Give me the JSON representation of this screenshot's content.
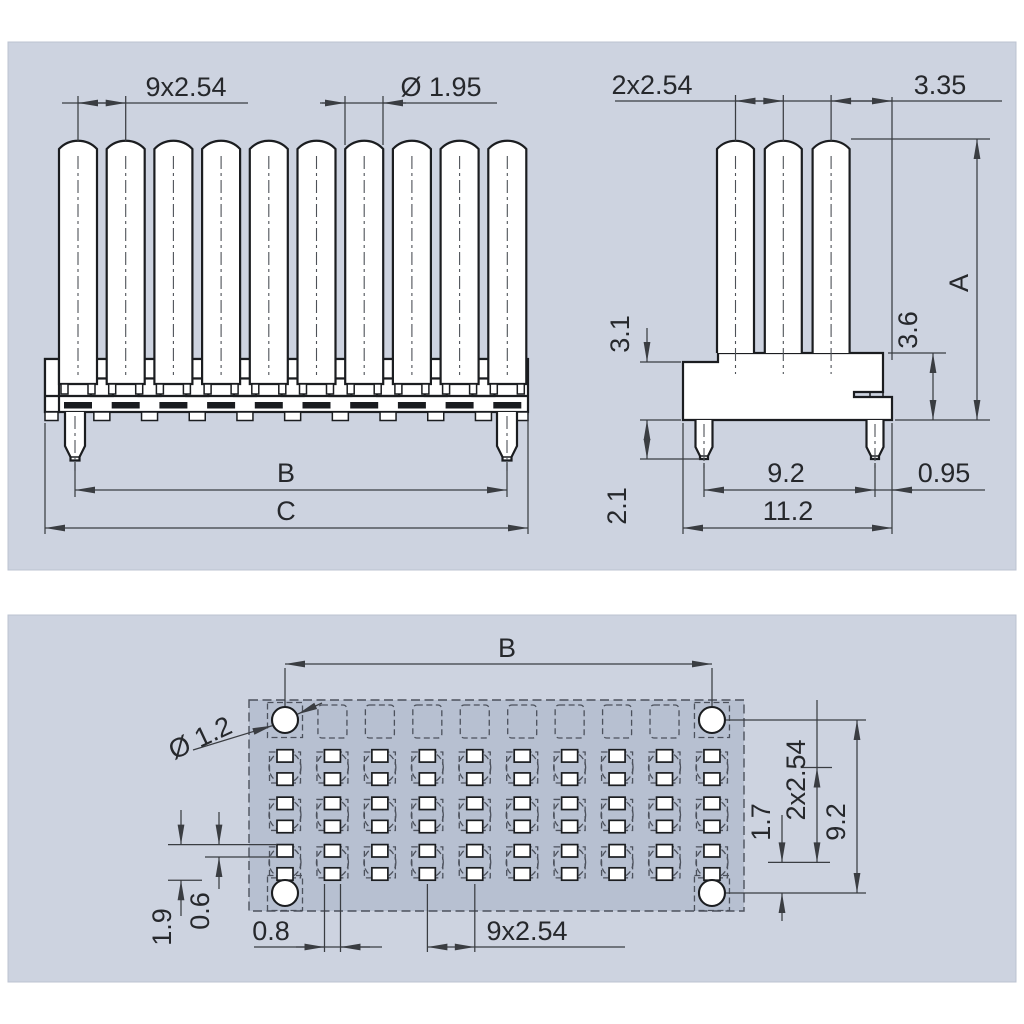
{
  "drawing": {
    "colors": {
      "page_bg": "#ffffff",
      "panel_bg": "#cdd3e0",
      "footprint_bg": "#b7c0d1",
      "object_line": "#1b1d20",
      "dimension_line": "#3a3d42",
      "text": "#26282c"
    },
    "front_view": {
      "pin_count": 10,
      "dims": {
        "pitch": "9x2.54",
        "pin_diameter": "Ø 1.95",
        "peg_span": "B",
        "overall_width": "C"
      }
    },
    "side_view": {
      "pin_count": 3,
      "dims": {
        "pitch": "2x2.54",
        "pin_to_edge": "3.35",
        "overall_height": "A",
        "seat_to_base": "3.6",
        "body_height": "3.1",
        "peg_length": "2.1",
        "peg_span": "9.2",
        "peg_to_edge": "0.95",
        "body_width": "11.2"
      }
    },
    "footprint_view": {
      "columns": 10,
      "pad_rows": 3,
      "dims": {
        "hole_span_x": "B",
        "hole_diameter": "Ø 1.2",
        "pad_row_span": "2x2.54",
        "hole_span_y": "9.2",
        "last_row_to_hole": "1.7",
        "pad_pair_height": "1.9",
        "pad_height": "0.6",
        "pad_width": "0.8",
        "pitch": "9x2.54"
      }
    }
  }
}
